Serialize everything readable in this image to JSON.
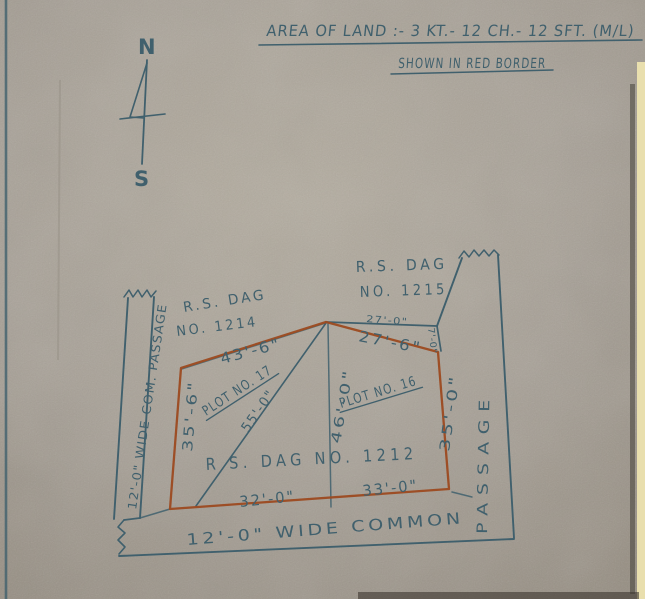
{
  "title": {
    "area": "AREA OF LAND :- 3 KT.- 12 CH.- 12 SFT. (M/L)",
    "shown": "SHOWN IN RED BORDER"
  },
  "compass": {
    "north": "N",
    "south": "S"
  },
  "parcels": {
    "dag1215": {
      "line1": "R.S. DAG",
      "line2": "NO. 1215"
    },
    "dag1214": {
      "line1": "R.S. DAG",
      "line2": "NO. 1214"
    },
    "dag1212": {
      "label": "R S. DAG NO. 1212"
    },
    "plot17": {
      "label": "PLOT NO. 17"
    },
    "plot16": {
      "label": "PLOT NO. 16"
    }
  },
  "dimensions": {
    "top_left_edge": "43'-6\"",
    "top_right_small": "27'-0\"",
    "top_right_edge": "27'-6\"",
    "notch": "7'-0\"",
    "diagonal": "55'-0\"",
    "divider": "46'-0\"",
    "west_edge": "35'-6\"",
    "east_edge": "35'-0\"",
    "bottom_left_edge": "32'-0\"",
    "bottom_right_edge": "33'-0\""
  },
  "passages": {
    "left": "12'-0\" WIDE COM. PASSAGE",
    "right": "PASSAGE",
    "bottom": "12'-0\"  WIDE  COMMON"
  },
  "colors": {
    "paper": "#a7a096",
    "ink": "#40606d",
    "red_border": "#9c4a20",
    "mat_edge": "#e9dfae"
  }
}
